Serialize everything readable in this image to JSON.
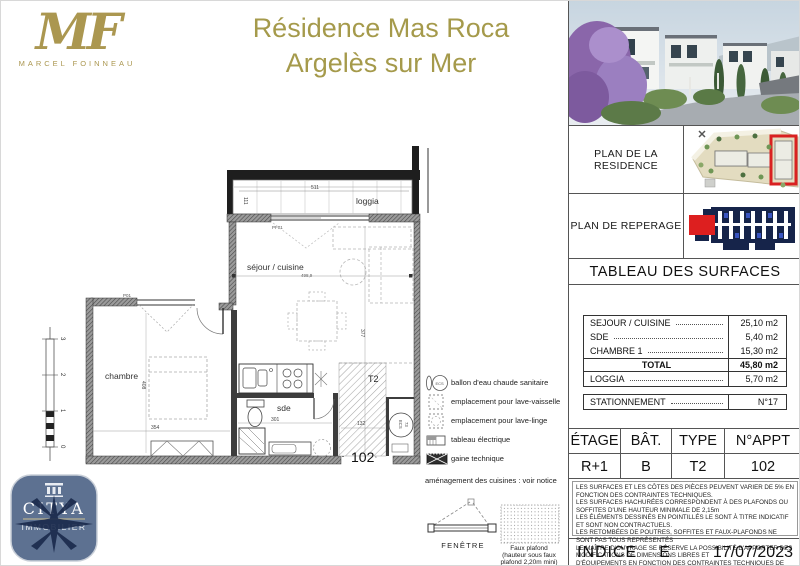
{
  "colors": {
    "accent_gold": "#A59A4B",
    "highlight_red": "#DD1F1F",
    "citya_slate": "#5D7191",
    "reperage_navy": "#16244A"
  },
  "header": {
    "logo_initials": "MF",
    "logo_name": "MARCEL FOINNEAU",
    "title_line1": "Résidence Mas Roca",
    "title_line2": "Argelès sur Mer"
  },
  "sidebar": {
    "plan_residence_label": "PLAN DE LA RESIDENCE",
    "plan_reperage_label": "PLAN DE REPERAGE",
    "surfaces": {
      "title": "TABLEAU DES SURFACES",
      "rows": [
        {
          "label": "SEJOUR / CUISINE",
          "value": "25,10 m2"
        },
        {
          "label": "SDE",
          "value": "5,40 m2"
        },
        {
          "label": "CHAMBRE 1",
          "value": "15,30 m2"
        }
      ],
      "total_label": "TOTAL",
      "total_value": "45,80 m2",
      "loggia_label": "LOGGIA",
      "loggia_value": "5,70 m2",
      "parking_label": "STATIONNEMENT",
      "parking_value": "N°17"
    },
    "unit_table": {
      "headers": [
        "ÉTAGE",
        "BÂT.",
        "TYPE",
        "N°APPT"
      ],
      "values": [
        "R+1",
        "B",
        "T2",
        "102"
      ]
    },
    "notes": [
      "LES SURFACES ET LES CÔTES DES PIÈCES PEUVENT VARIER DE 5% EN FONCTION DES CONTRAINTES TECHNIQUES.",
      "LES SURFACES HACHURÉES CORRESPONDENT À DES PLAFONDS OU SOFFITES D'UNE HAUTEUR MINIMALE DE 2,15m",
      "LES ÉLÉMENTS DESSINÉS EN POINTILLÉS LE SONT À TITRE INDICATIF ET SONT NON CONTRACTUELS.",
      "LES RETOMBÉES DE POUTRES, SOFFITES ET FAUX-PLAFONDS NE SONT PAS TOUS REPRÉSENTÉS",
      "LE MAÎTRE D'OUVRAGE SE RÉSERVE LA POSSIBILITÉ D'APPORTER DES MODIFICATIONS DE DIMENSIONS LIBRES ET",
      "D'ÉQUIPEMENTS EN FONCTION DES CONTRAINTES TECHNIQUES DE CONSTRUCTION.",
      "VISUEL DE LA RESIDENCE NON CONTRACTUEL"
    ],
    "indice_label": "INDICE",
    "indice_value": "E",
    "date": "17/07/2023"
  },
  "plan": {
    "rooms": {
      "loggia": "loggia",
      "sejour": "séjour / cuisine",
      "chambre": "chambre",
      "sde": "sde"
    },
    "unit_type": "T2",
    "unit_number": "102",
    "labels": {
      "ecs": "ECS",
      "pf01": "PF01",
      "p01": "P01"
    },
    "dims": {
      "loggia_w": "511",
      "loggia_h": "111",
      "sejour_w": "498,9",
      "sejour_h": "377",
      "chambre_w": "354",
      "chambre_h": "408",
      "sde_w": "301",
      "palier_w": "132",
      "ecs_d": "73"
    },
    "scale_ticks": [
      "3",
      "2",
      "1",
      "0"
    ]
  },
  "legend": {
    "items": [
      "ballon d'eau chaude sanitaire",
      "emplacement pour lave-vaisselle",
      "emplacement pour lave-linge",
      "tableau électrique",
      "gaine technique"
    ],
    "kitchen_note": "aménagement des cuisines : voir notice",
    "window_label": "FENÊTRE",
    "false_ceiling_lines": [
      "Faux plafond",
      "(hauteur sous faux",
      "plafond 2,20m mini)"
    ]
  },
  "citya": {
    "name": "CITYA",
    "subtitle": "IMMOBILIER"
  }
}
